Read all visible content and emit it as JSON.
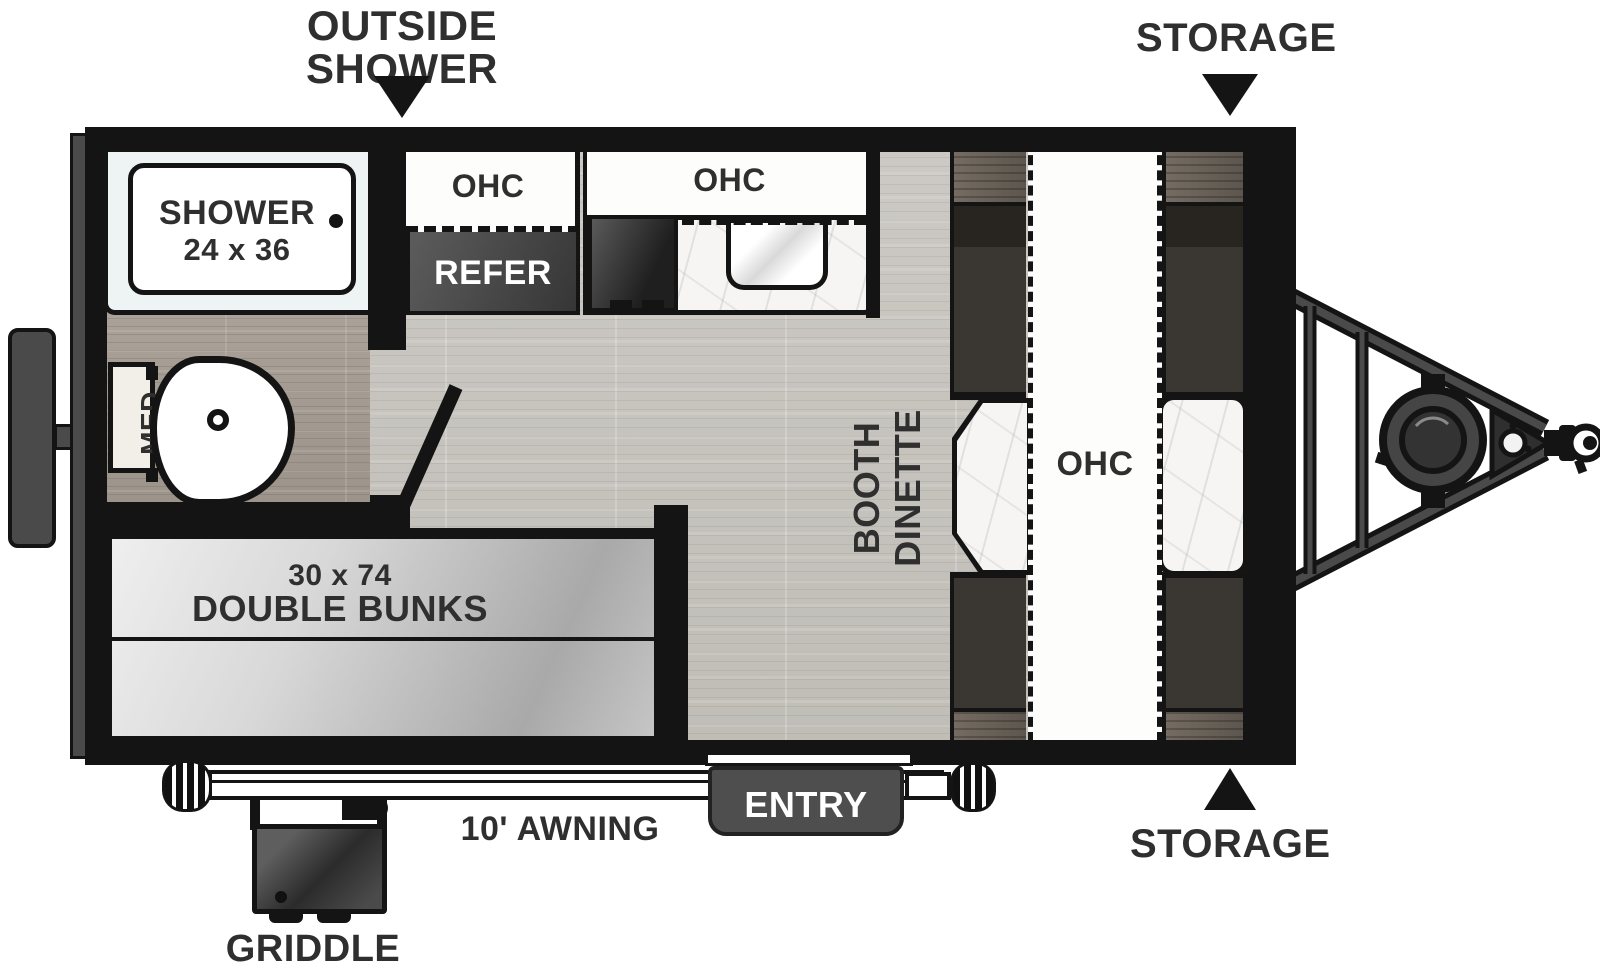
{
  "callouts": {
    "outside_shower": {
      "line1": "OUTSIDE",
      "line2": "SHOWER"
    },
    "storage_top": "STORAGE",
    "storage_bottom": "STORAGE",
    "awning": "10' AWNING",
    "griddle": "GRIDDLE",
    "entry": "ENTRY"
  },
  "bathroom": {
    "shower_label": "SHOWER",
    "shower_size": "24 x 36",
    "med": "MED"
  },
  "kitchen": {
    "ohc_left": "OHC",
    "ohc_main": "OHC",
    "refer": "REFER"
  },
  "dinette": {
    "line1": "BOOTH",
    "line2": "DINETTE",
    "ohc": "OHC"
  },
  "bunks": {
    "size": "30 x 74",
    "label": "DOUBLE BUNKS"
  },
  "colors": {
    "ink": "#141414",
    "label_text": "#2f2f2f",
    "floor_light": "#c8c5c0",
    "floor_dark": "#a69e94",
    "bench": "#3a3733",
    "bench_back": "#282420",
    "wood_trim": "#6b635a",
    "appliance_gray": "#4a4a4a",
    "marble": "#f6f5f3",
    "mattress": "#d9d9d9",
    "white": "#ffffff"
  }
}
